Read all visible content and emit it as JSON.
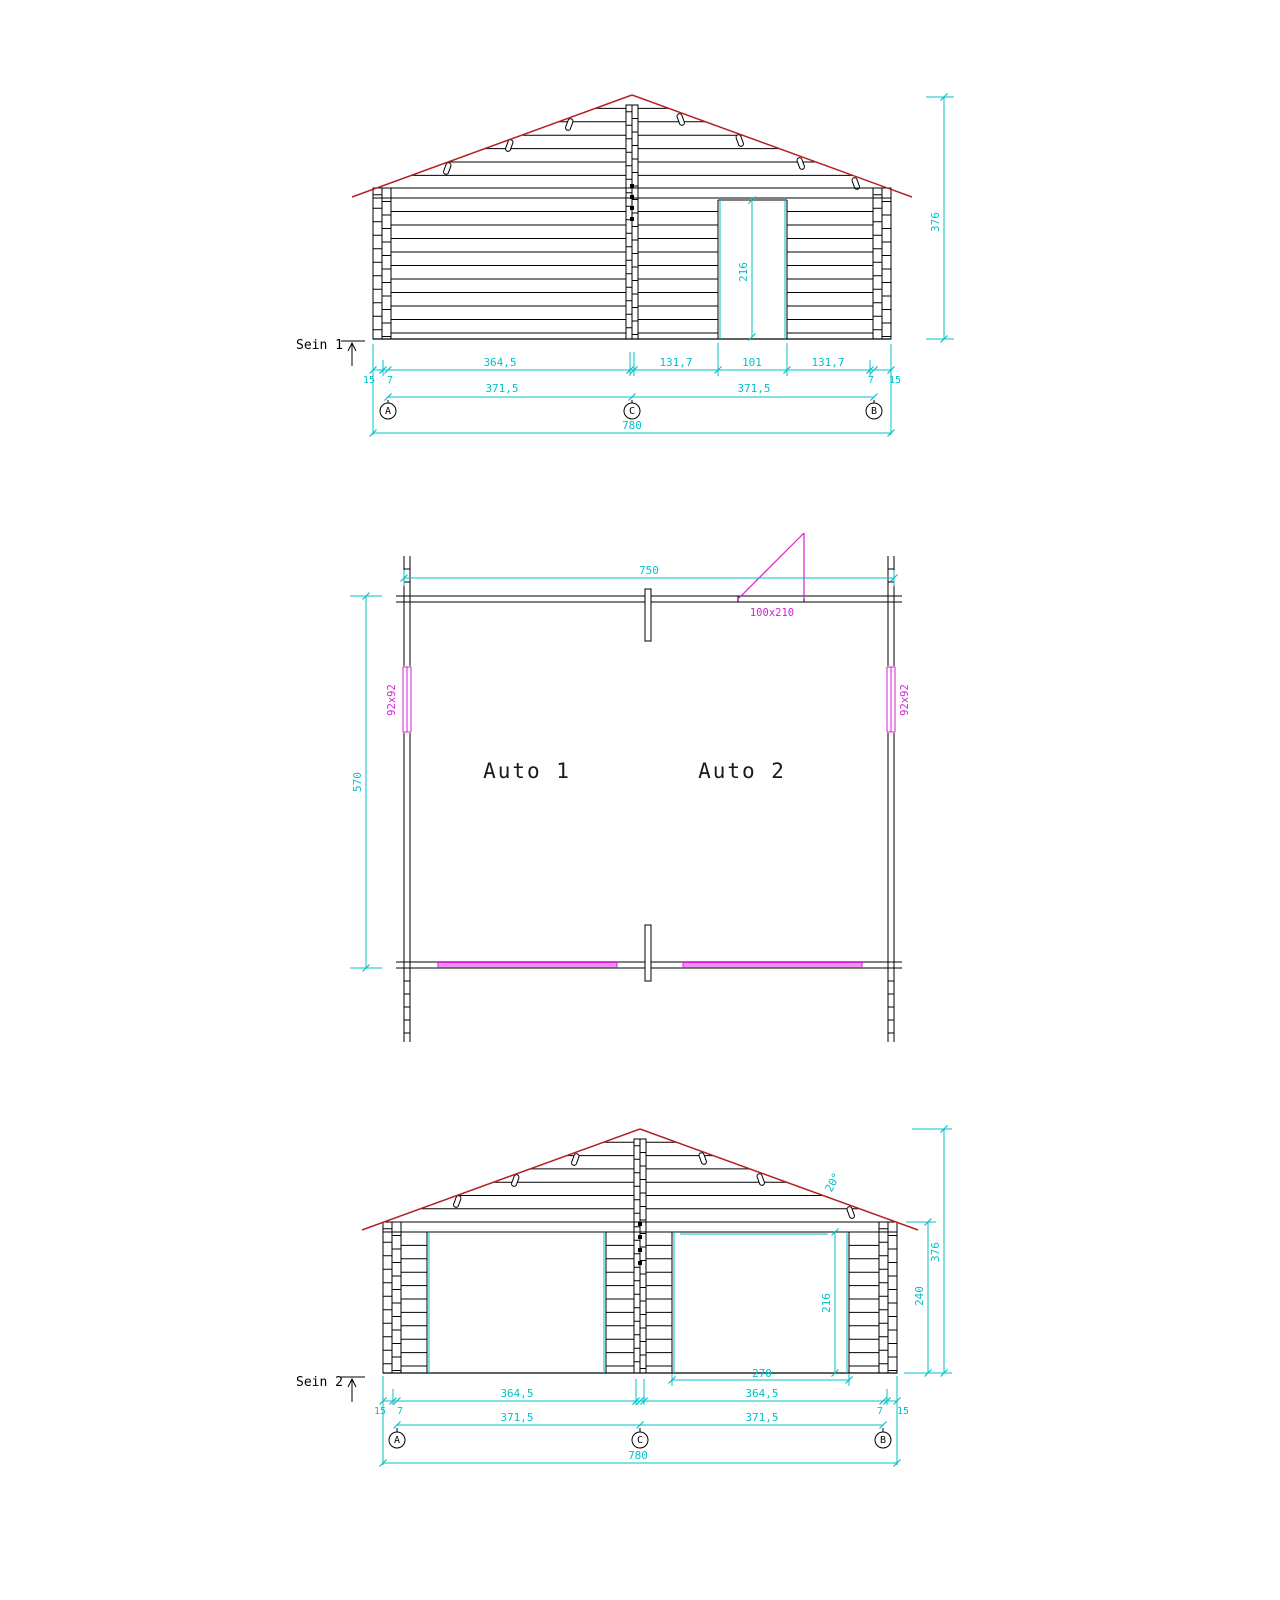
{
  "top_view": {
    "label": "Sein 1",
    "axes": [
      "A",
      "C",
      "B"
    ],
    "dims": {
      "overall": "780",
      "seg_left": "364,5",
      "seg_mid_left": "131,7",
      "seg_door": "101",
      "seg_mid_right": "131,7",
      "half_left": "371,5",
      "half_right": "371,5",
      "edge_left_15": "15",
      "edge_left_7": "7",
      "edge_right_7": "7",
      "edge_right_15": "15",
      "total_height": "376",
      "door_height": "216"
    }
  },
  "plan_view": {
    "width": "750",
    "depth": "570",
    "door_size": "100x210",
    "window_left": "92x92",
    "window_right": "92x92",
    "bay_left": "Auto 1",
    "bay_right": "Auto 2"
  },
  "bottom_view": {
    "label": "Sein 2",
    "axes": [
      "A",
      "C",
      "B"
    ],
    "dims": {
      "overall": "780",
      "seg_left": "364,5",
      "seg_right": "364,5",
      "half_left": "371,5",
      "half_right": "371,5",
      "edge_left_15": "15",
      "edge_left_7": "7",
      "edge_right_7": "7",
      "edge_right_15": "15",
      "total_height": "376",
      "wall_height": "240",
      "opening_height": "216",
      "opening_width": "270",
      "roof_angle": "20°"
    }
  },
  "colors": {
    "line": "#000000",
    "roof": "#b22222",
    "dimension": "#00c2c9",
    "accent": "#d41fd4"
  }
}
